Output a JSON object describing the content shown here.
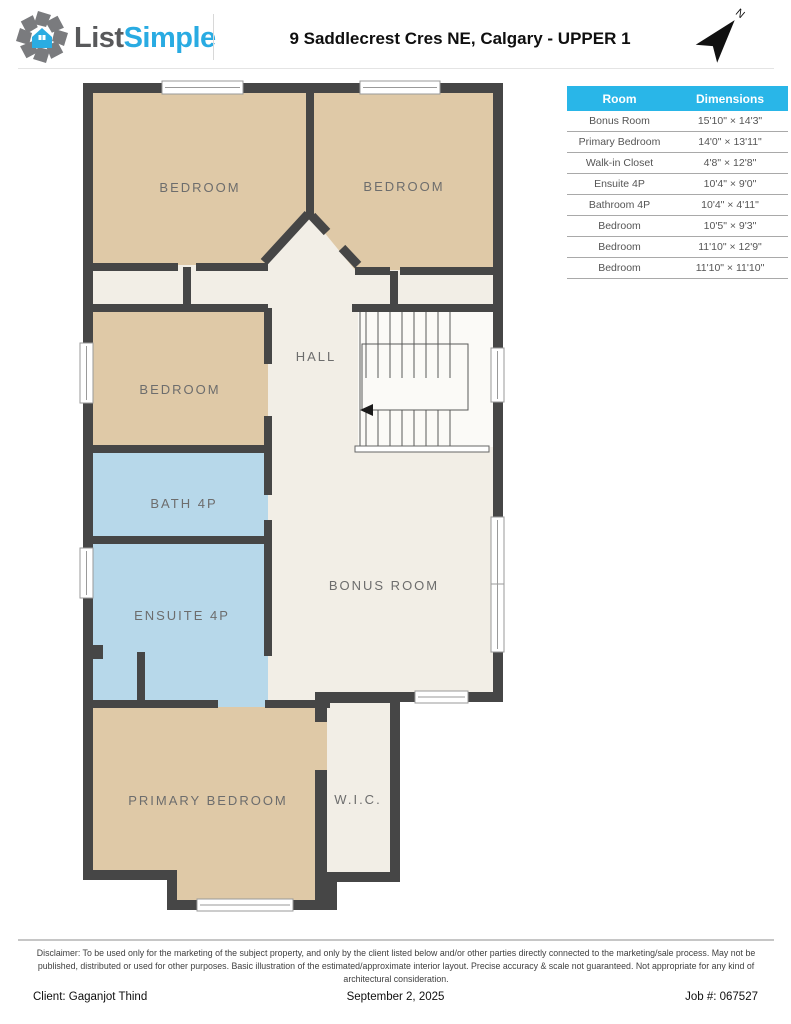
{
  "header": {
    "brand_part1": "List",
    "brand_part2": "Simple",
    "title": "9 Saddlecrest Cres NE, Calgary - UPPER 1",
    "compass_label": "N"
  },
  "floor_plan": {
    "rooms": {
      "bedroom_tl": "BEDROOM",
      "bedroom_tr": "BEDROOM",
      "bedroom_mid": "BEDROOM",
      "hall": "HALL",
      "bath": "BATH 4P",
      "ensuite": "ENSUITE 4P",
      "bonus": "BONUS ROOM",
      "primary": "PRIMARY BEDROOM",
      "wic": "W.I.C."
    },
    "colors": {
      "wall": "#464646",
      "bedroom_fill": "#dfc9a7",
      "bathroom_fill": "#b7d8ea",
      "common_fill": "#f2eee6",
      "label": "#6d6d6d"
    }
  },
  "dimensions_table": {
    "headers": [
      "Room",
      "Dimensions"
    ],
    "rows": [
      {
        "room": "Bonus Room",
        "dimensions": "15'10\" × 14'3\""
      },
      {
        "room": "Primary Bedroom",
        "dimensions": "14'0\" × 13'11\""
      },
      {
        "room": "Walk-in Closet",
        "dimensions": "4'8\" × 12'8\""
      },
      {
        "room": "Ensuite 4P",
        "dimensions": "10'4\" × 9'0\""
      },
      {
        "room": "Bathroom 4P",
        "dimensions": "10'4\" × 4'11\""
      },
      {
        "room": "Bedroom",
        "dimensions": "10'5\" × 9'3\""
      },
      {
        "room": "Bedroom",
        "dimensions": "11'10\" × 12'9\""
      },
      {
        "room": "Bedroom",
        "dimensions": "11'10\" × 11'10\""
      }
    ],
    "header_color": "#29b6e8"
  },
  "footer": {
    "disclaimer": "Disclaimer: To be used only for the marketing of the subject property, and only by the client listed below and/or other parties directly connected to the marketing/sale process. May not be published, distributed or used for other purposes. Basic illustration of the estimated/approximate interior layout. Precise accuracy & scale not guaranteed. Not appropriate for any kind of architectural consideration.",
    "client": "Client: Gaganjot Thind",
    "date": "September 2, 2025",
    "job": "Job #: 067527"
  }
}
